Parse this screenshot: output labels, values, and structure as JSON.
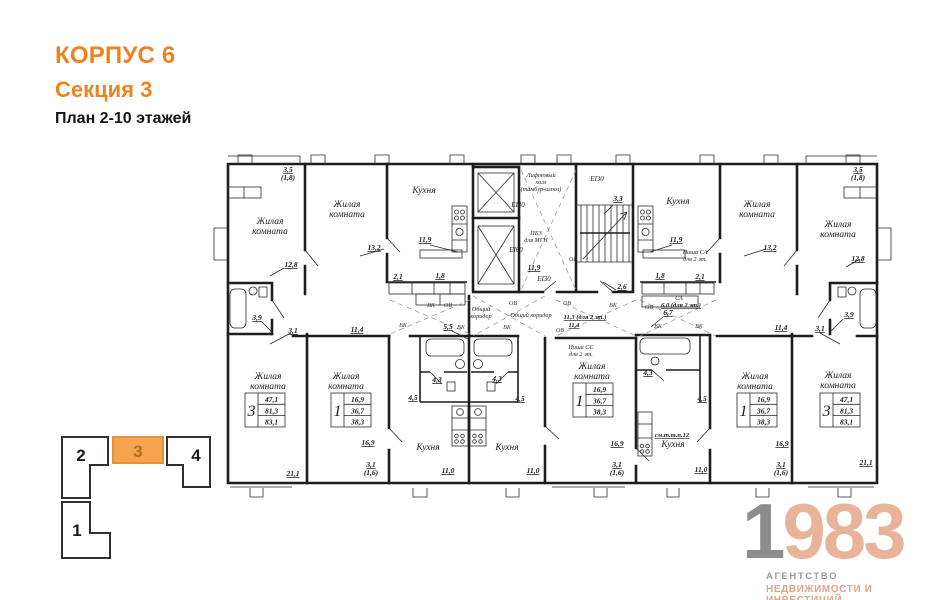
{
  "header": {
    "line1": "КОРПУС 6",
    "line2": "Секция 3",
    "line3": "План 2-10 этажей"
  },
  "sections": {
    "s2": "2",
    "s3": "3",
    "s4": "4",
    "s1": "1",
    "active": "3",
    "active_color": "#f5a44f"
  },
  "logo": {
    "one": "1",
    "nine83": "983",
    "sub1": "АГЕНТСТВО",
    "sub2": "НЕДВИЖИМОСТИ И ИНВЕСТИЦИЙ",
    "gray": "#8d8d8d",
    "salmon": "#e9b39a"
  },
  "accent_color": "#ee821e",
  "t": {
    "living1": "Жилая",
    "living2": "комната",
    "kitchen": "Кухня",
    "lift1": "Лифтовый",
    "lift2": "холл",
    "lift3": "(тамбур-шлюз)",
    "pbz1": "ПБЗ",
    "pbz2": "для МГН",
    "ei30": "EI30",
    "ei60": "EI60",
    "corr1": "Общий",
    "corr2": "коридор",
    "corr": "Общий коридор",
    "vk": "ВК",
    "ov": "ОВ",
    "niche_ss": "Ниша СС",
    "niche_sa": "Ниша СА",
    "for2": "для 2 эт.",
    "sa": "СА",
    "sa60": "6,0 (для 2 эт.)",
    "smttp": "см.т.т.п.12"
  },
  "dims": {
    "d35": "3,5",
    "d18b": "(1,8)",
    "d128": "12,8",
    "d132": "13,2",
    "d119": "11,9",
    "d21": "2,1",
    "d18": "1,8",
    "d39": "3,9",
    "d31": "3,1",
    "d114": "11,4",
    "d55": "5,5",
    "d113": "11,3 (для 2 эт.)",
    "d33": "3,3",
    "d26": "2,6",
    "d67": "6,7",
    "d43": "4,3",
    "d45": "4,5",
    "d169": "16,9",
    "d16b": "(1,6)",
    "d110": "11,0",
    "d211": "21,1"
  },
  "apt3": {
    "rooms": "3",
    "v1": "47,1",
    "v2": "81,3",
    "v3": "83,1"
  },
  "apt1": {
    "rooms": "1",
    "v1": "16,9",
    "v2": "36,7",
    "v3": "38,3"
  }
}
